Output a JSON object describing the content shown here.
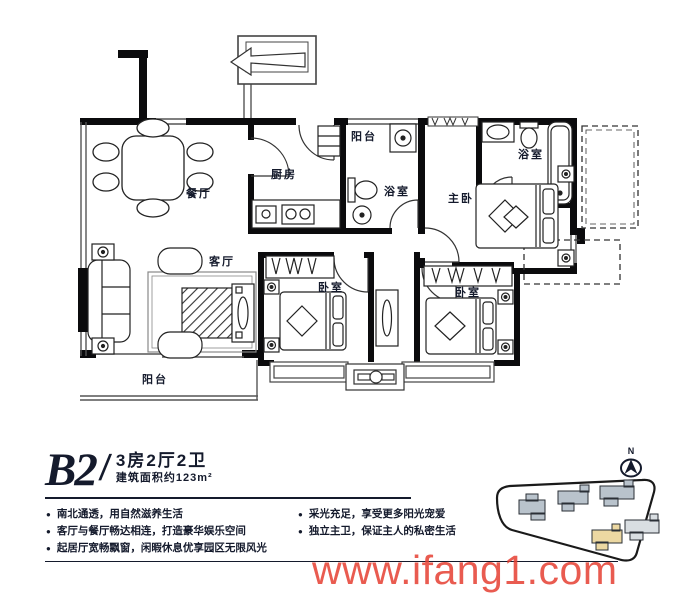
{
  "unit": {
    "code": "B2",
    "slash": "/",
    "layout": "3房2厅2卫",
    "area": "建筑面积约123m²"
  },
  "rooms": {
    "dining": "餐厅",
    "kitchen": "厨房",
    "balcony_top": "阳台",
    "bath_shared": "浴室",
    "bath_master": "浴室",
    "master_bedroom": "主卧",
    "living": "客厅",
    "bedroom_a": "卧室",
    "bedroom_b": "卧室",
    "balcony_main": "阳台"
  },
  "features": {
    "left": [
      "南北通透，用自然滋养生活",
      "客厅与餐厅畅达相连，打造豪华娱乐空间",
      "起居厅宽畅飘窗，闲暇休息优享园区无限风光"
    ],
    "right": [
      "采光充足，享受更多阳光宠爱",
      "独立主卫，保证主人的私密生活"
    ]
  },
  "compass": {
    "label": "N"
  },
  "watermark": {
    "text": "www.ifang1.com"
  },
  "colors": {
    "ink": "#141a2c",
    "watermark-red": "#e53e31",
    "site-building": "#b9c3cc",
    "site-highlight": "#ecd8a2",
    "site-light": "#d9dee2"
  }
}
